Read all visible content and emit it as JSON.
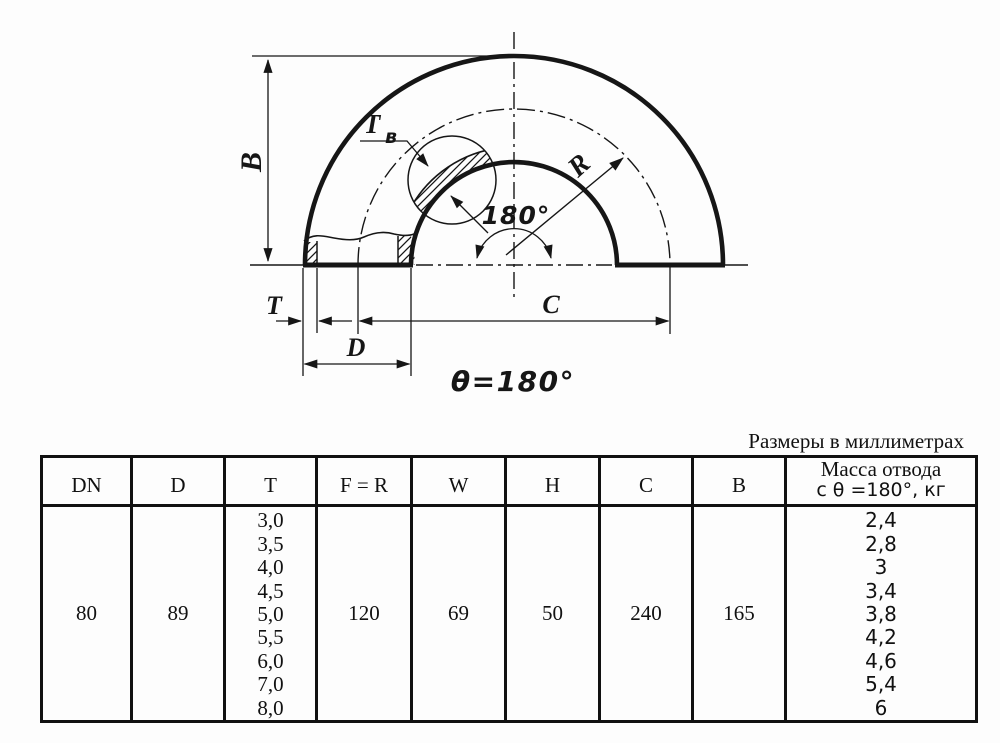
{
  "page": {
    "background": "#fdfdfd",
    "ink": "#161616"
  },
  "drawing": {
    "description": "Section drawing of a 180-degree return pipe elbow",
    "labels": {
      "b": "B",
      "t_wall_main": "T",
      "t_wall_sub": "в",
      "radius": "R",
      "angle_arc": "180°",
      "t": "T",
      "d": "D",
      "c": "C",
      "theta_note": "θ=180°"
    }
  },
  "table": {
    "caption": "Размеры в миллиметрах",
    "headers": [
      "DN",
      "D",
      "T",
      "F = R",
      "W",
      "H",
      "C",
      "B"
    ],
    "mass_header": {
      "line1": "Масса отвода",
      "line2": "с θ =180°, кг"
    },
    "row": {
      "dn": "80",
      "d": "89",
      "t_values": [
        "3,0",
        "3,5",
        "4,0",
        "4,5",
        "5,0",
        "5,5",
        "6,0",
        "7,0",
        "8,0"
      ],
      "f_r": "120",
      "w": "69",
      "h": "50",
      "c": "240",
      "b": "165",
      "mass_values": [
        "2,4",
        "2,8",
        "3",
        "3,4",
        "3,8",
        "4,2",
        "4,6",
        "5,4",
        "6"
      ]
    }
  }
}
